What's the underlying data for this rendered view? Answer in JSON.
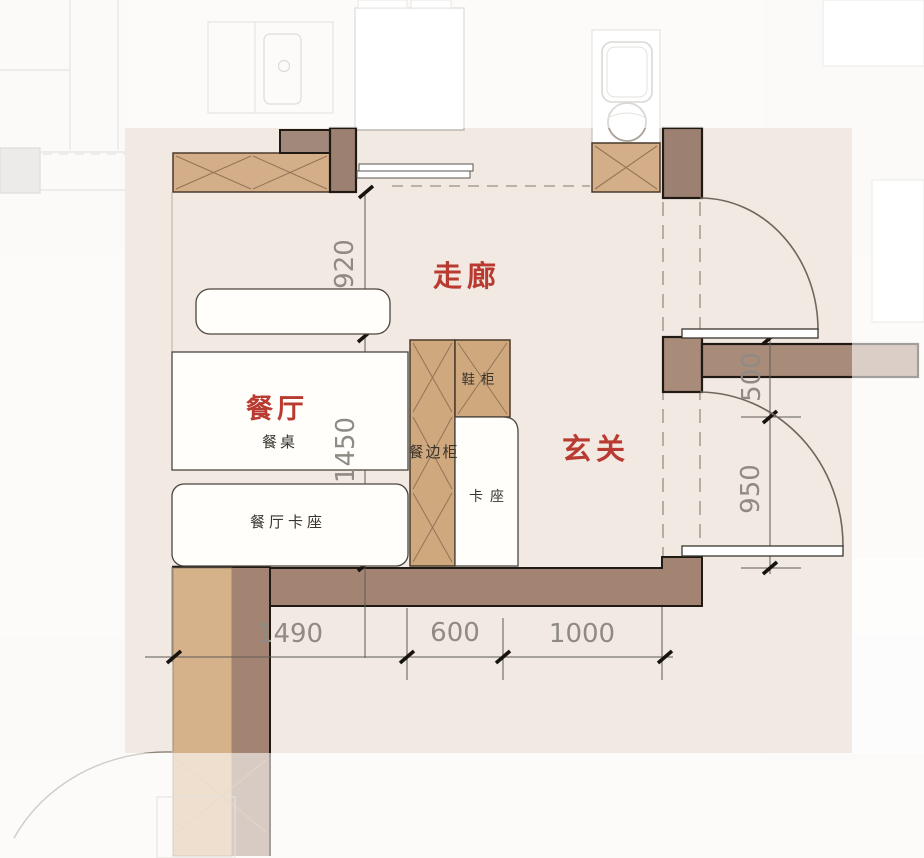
{
  "plan": {
    "type": "floor-plan",
    "rooms": {
      "corridor": "走廊",
      "dining": "餐厅",
      "entry": "玄关"
    },
    "furniture": {
      "dining_table": "餐桌",
      "dining_booth": "餐厅卡座",
      "sideboard": "餐边柜",
      "shoe_cabinet": "鞋柜",
      "booth": "卡座"
    },
    "dimensions": {
      "left_upper": "920",
      "left_lower": "1450",
      "right_upper": "500",
      "right_lower": "950",
      "bottom_left": "1490",
      "bottom_mid": "600",
      "bottom_right": "1000"
    },
    "colors": {
      "room_label": "#b93a30",
      "dim_text": "#8f8b84",
      "plan_bg": "#f1e9e2",
      "outer_bg": "#f7f5f2",
      "wall_hatched": "#d4ae88",
      "wall_solid": "#a38976",
      "hatch_line": "#8a6b4f"
    }
  }
}
